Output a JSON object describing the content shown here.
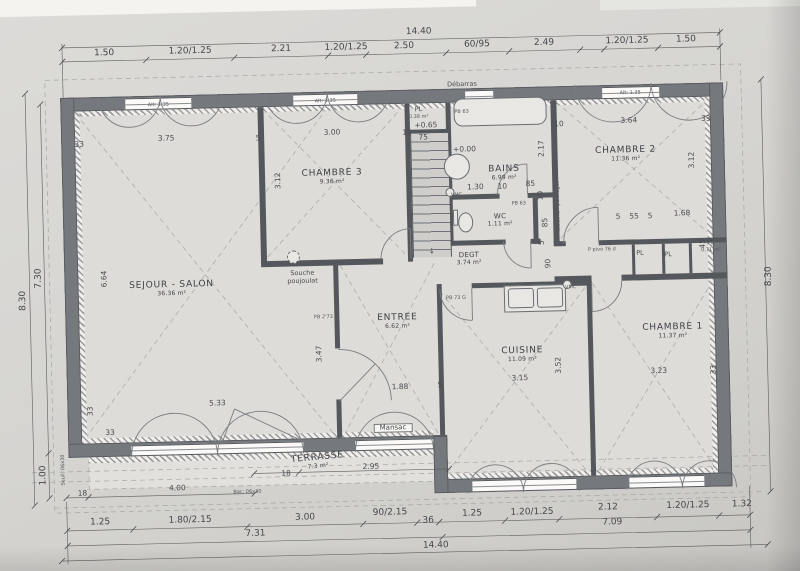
{
  "plan": {
    "total_width_label": "14.40",
    "total_height_label": "8.30",
    "items": [
      {
        "c": "r",
        "n": "room-label-sejour-salon",
        "t": "SEJOUR - SALON",
        "s": "36.36 m²",
        "x": 172,
        "y": 284
      },
      {
        "c": "r",
        "n": "room-label-chambre-3",
        "t": "CHAMBRE 3",
        "s": "9.36 m²",
        "x": 335,
        "y": 176
      },
      {
        "c": "r",
        "n": "room-label-bains",
        "t": "BAINS",
        "s": "6.99 m²",
        "x": 507,
        "y": 176
      },
      {
        "c": "r",
        "n": "room-label-chambre-2",
        "t": "CHAMBRE 2",
        "s": "11.36 m²",
        "x": 629,
        "y": 160
      },
      {
        "c": "r2",
        "n": "room-label-wc",
        "t": "WC",
        "s": "1.11 m²",
        "x": 502,
        "y": 223
      },
      {
        "c": "r2",
        "n": "room-label-degt",
        "t": "DEGT",
        "s": "3.74 m²",
        "x": 470,
        "y": 261
      },
      {
        "c": "r",
        "n": "room-label-entree",
        "t": "ENTREE",
        "s": "6.62 m²",
        "x": 397,
        "y": 322
      },
      {
        "c": "r",
        "n": "room-label-cuisine",
        "t": "CUISINE",
        "s": "11.09 m²",
        "x": 521,
        "y": 358
      },
      {
        "c": "r",
        "n": "room-label-chambre-1",
        "t": "CHAMBRE 1",
        "s": "11.37 m²",
        "x": 672,
        "y": 338
      },
      {
        "c": "r terr",
        "n": "room-label-terrasse",
        "t": "TERRASSE",
        "s": "7.3 m²",
        "x": 314,
        "y": 460
      },
      {
        "c": "d",
        "t": "1.50",
        "x": 110,
        "y": 47
      },
      {
        "c": "d",
        "t": "1.20/1.25",
        "x": 196,
        "y": 47
      },
      {
        "c": "d",
        "t": "2.21",
        "x": 287,
        "y": 47
      },
      {
        "c": "d",
        "t": "1.20/1.25",
        "x": 352,
        "y": 47
      },
      {
        "c": "d",
        "t": "2.50",
        "x": 410,
        "y": 47
      },
      {
        "c": "d",
        "t": "60/95",
        "x": 483,
        "y": 47
      },
      {
        "c": "d",
        "t": "2.49",
        "x": 550,
        "y": 47
      },
      {
        "c": "d",
        "t": "1.20/1.25",
        "x": 633,
        "y": 47
      },
      {
        "c": "d",
        "t": "1.50",
        "x": 692,
        "y": 47
      },
      {
        "c": "d",
        "t": "14.40",
        "x": 425,
        "y": 33
      },
      {
        "c": "d",
        "t": "1.25",
        "x": 95,
        "y": 516
      },
      {
        "c": "d",
        "t": "1.80/2.15",
        "x": 185,
        "y": 516
      },
      {
        "c": "d",
        "t": "3.00",
        "x": 300,
        "y": 516
      },
      {
        "c": "d",
        "t": "90/2.15",
        "x": 385,
        "y": 513
      },
      {
        "c": "d",
        "t": "36",
        "x": 423,
        "y": 522
      },
      {
        "c": "d",
        "t": "1.25",
        "x": 467,
        "y": 516
      },
      {
        "c": "d",
        "t": "1.20/1.25",
        "x": 527,
        "y": 516
      },
      {
        "c": "d",
        "t": "2.12",
        "x": 603,
        "y": 513
      },
      {
        "c": "d",
        "t": "1.20/1.25",
        "x": 683,
        "y": 513
      },
      {
        "c": "d",
        "t": "1.32",
        "x": 737,
        "y": 513
      },
      {
        "c": "d",
        "t": "7.31",
        "x": 250,
        "y": 531
      },
      {
        "c": "d",
        "t": "7.09",
        "x": 607,
        "y": 528
      },
      {
        "c": "d",
        "t": "14.40",
        "x": 430,
        "y": 547
      },
      {
        "c": "d",
        "v": 1,
        "t": "8.30",
        "x": 24,
        "y": 292
      },
      {
        "c": "d",
        "v": 1,
        "t": "7.30",
        "x": 40,
        "y": 270
      },
      {
        "c": "d",
        "v": 1,
        "t": "1.00",
        "x": 40,
        "y": 467
      },
      {
        "c": "d",
        "v": 1,
        "t": "8.30",
        "x": 770,
        "y": 285
      },
      {
        "c": "i",
        "t": "33",
        "x": 83,
        "y": 137
      },
      {
        "c": "i",
        "t": "3.75",
        "x": 170,
        "y": 133
      },
      {
        "c": "i",
        "t": "5",
        "x": 262,
        "y": 135
      },
      {
        "c": "i",
        "t": "3.00",
        "x": 336,
        "y": 131
      },
      {
        "c": "i",
        "t": "10",
        "x": 411,
        "y": 133
      },
      {
        "c": "i",
        "t": "10",
        "x": 563,
        "y": 128
      },
      {
        "c": "i",
        "t": "3.64",
        "x": 633,
        "y": 126
      },
      {
        "c": "i",
        "t": "33",
        "x": 710,
        "y": 126
      },
      {
        "c": "i",
        "v": 1,
        "t": "3.12",
        "x": 281,
        "y": 178
      },
      {
        "c": "i",
        "v": 1,
        "t": "3.12",
        "x": 695,
        "y": 167
      },
      {
        "c": "i",
        "v": 1,
        "t": "6.64",
        "x": 105,
        "y": 272
      },
      {
        "c": "i",
        "v": 1,
        "t": "2.17",
        "x": 545,
        "y": 152
      },
      {
        "c": "i",
        "t": "1.30",
        "x": 478,
        "y": 189
      },
      {
        "c": "i",
        "t": "10",
        "x": 505,
        "y": 189
      },
      {
        "c": "i",
        "t": "85",
        "x": 533,
        "y": 187
      },
      {
        "c": "i",
        "t": "5",
        "x": 620,
        "y": 222
      },
      {
        "c": "i",
        "t": "55",
        "x": 636,
        "y": 222
      },
      {
        "c": "i",
        "t": "5",
        "x": 652,
        "y": 222
      },
      {
        "c": "i",
        "t": "1.68",
        "x": 684,
        "y": 220
      },
      {
        "c": "i",
        "v": 1,
        "t": "45",
        "x": 704,
        "y": 251
      },
      {
        "c": "i",
        "v": 1,
        "t": "10",
        "x": 543,
        "y": 199
      },
      {
        "c": "i",
        "v": 1,
        "t": "85",
        "x": 547,
        "y": 226
      },
      {
        "c": "i",
        "v": 1,
        "t": "5",
        "x": 543,
        "y": 246
      },
      {
        "c": "i",
        "v": 1,
        "t": "90",
        "x": 549,
        "y": 267
      },
      {
        "c": "i",
        "v": 1,
        "t": "3.47",
        "x": 318,
        "y": 352
      },
      {
        "c": "i",
        "t": "1.88",
        "x": 398,
        "y": 387
      },
      {
        "c": "i",
        "t": "5",
        "x": 438,
        "y": 386
      },
      {
        "c": "i",
        "t": "5.33",
        "x": 215,
        "y": 399
      },
      {
        "c": "i",
        "v": 1,
        "t": "33",
        "x": 88,
        "y": 404
      },
      {
        "c": "i",
        "t": "33",
        "x": 107,
        "y": 426
      },
      {
        "c": "i",
        "t": "3.15",
        "x": 518,
        "y": 381
      },
      {
        "c": "i",
        "v": 1,
        "t": "3.52",
        "x": 557,
        "y": 369
      },
      {
        "c": "i",
        "t": "3.23",
        "x": 657,
        "y": 377
      },
      {
        "c": "i",
        "v": 1,
        "t": "33",
        "x": 712,
        "y": 377
      },
      {
        "c": "i",
        "t": "4.00",
        "x": 173,
        "y": 483
      },
      {
        "c": "i",
        "t": "18",
        "x": 78,
        "y": 486
      },
      {
        "c": "i",
        "t": "18",
        "x": 282,
        "y": 471
      },
      {
        "c": "i",
        "t": "2.95",
        "x": 367,
        "y": 466
      },
      {
        "c": "i",
        "t": "75",
        "x": 427,
        "y": 138
      },
      {
        "c": "i",
        "t": "+0.65",
        "x": 430,
        "y": 126
      },
      {
        "c": "i",
        "t": "+0.00",
        "x": 468,
        "y": 151
      },
      {
        "c": "i",
        "n": "stair-direction-arrow",
        "t": "↓",
        "x": 433,
        "y": 252
      },
      {
        "c": "a",
        "t": "PL",
        "x": 423,
        "y": 110
      },
      {
        "c": "m",
        "t": "0.38 m²",
        "x": 423,
        "y": 118
      },
      {
        "c": "m",
        "t": "PB 63",
        "x": 466,
        "y": 114
      },
      {
        "c": "m",
        "t": "PB 63",
        "x": 521,
        "y": 207
      },
      {
        "c": "m",
        "t": "VMC",
        "x": 459,
        "y": 197
      },
      {
        "c": "m",
        "t": "VMC",
        "x": 571,
        "y": 292
      },
      {
        "c": "m",
        "v": 1,
        "t": "Cloisons hydrofuges",
        "x": 561,
        "y": 210
      },
      {
        "c": "a",
        "t": "Souche",
        "x": 303,
        "y": 271
      },
      {
        "c": "a",
        "t": "poujoulat",
        "x": 303,
        "y": 279
      },
      {
        "c": "m",
        "t": "PB 2'73",
        "x": 323,
        "y": 316
      },
      {
        "c": "m",
        "t": "PB 73 G",
        "x": 456,
        "y": 300
      },
      {
        "c": "m",
        "t": "P pivo 76 d",
        "x": 603,
        "y": 255
      },
      {
        "c": "a",
        "t": "PL",
        "x": 641,
        "y": 259
      },
      {
        "c": "a",
        "t": "PL",
        "x": 669,
        "y": 261
      },
      {
        "c": "a",
        "t": "PL",
        "x": 712,
        "y": 250
      },
      {
        "c": "m",
        "t": "0.71 m²",
        "x": 712,
        "y": 258
      },
      {
        "c": "a box",
        "n": "door-brand-label",
        "t": "Mansac",
        "x": 390,
        "y": 428
      },
      {
        "c": "a",
        "t": "Débarras",
        "x": 467,
        "y": 86
      },
      {
        "c": "m",
        "t": "Alt: 1.35",
        "x": 163,
        "y": 100
      },
      {
        "c": "m",
        "t": "Alt: 1.35",
        "x": 330,
        "y": 100
      },
      {
        "c": "m",
        "t": "Alt: 1.35",
        "x": 635,
        "y": 99
      },
      {
        "c": "m",
        "v": 1,
        "t": "Seuil: 06x30",
        "x": 60,
        "y": 462
      },
      {
        "c": "m",
        "t": "Bac: 06x30",
        "x": 243,
        "y": 489
      }
    ]
  },
  "colors": {
    "paper": "#d7d6d2",
    "wall": "#75797d",
    "line": "#5a5c5e",
    "dash": "#a3a3a1"
  }
}
